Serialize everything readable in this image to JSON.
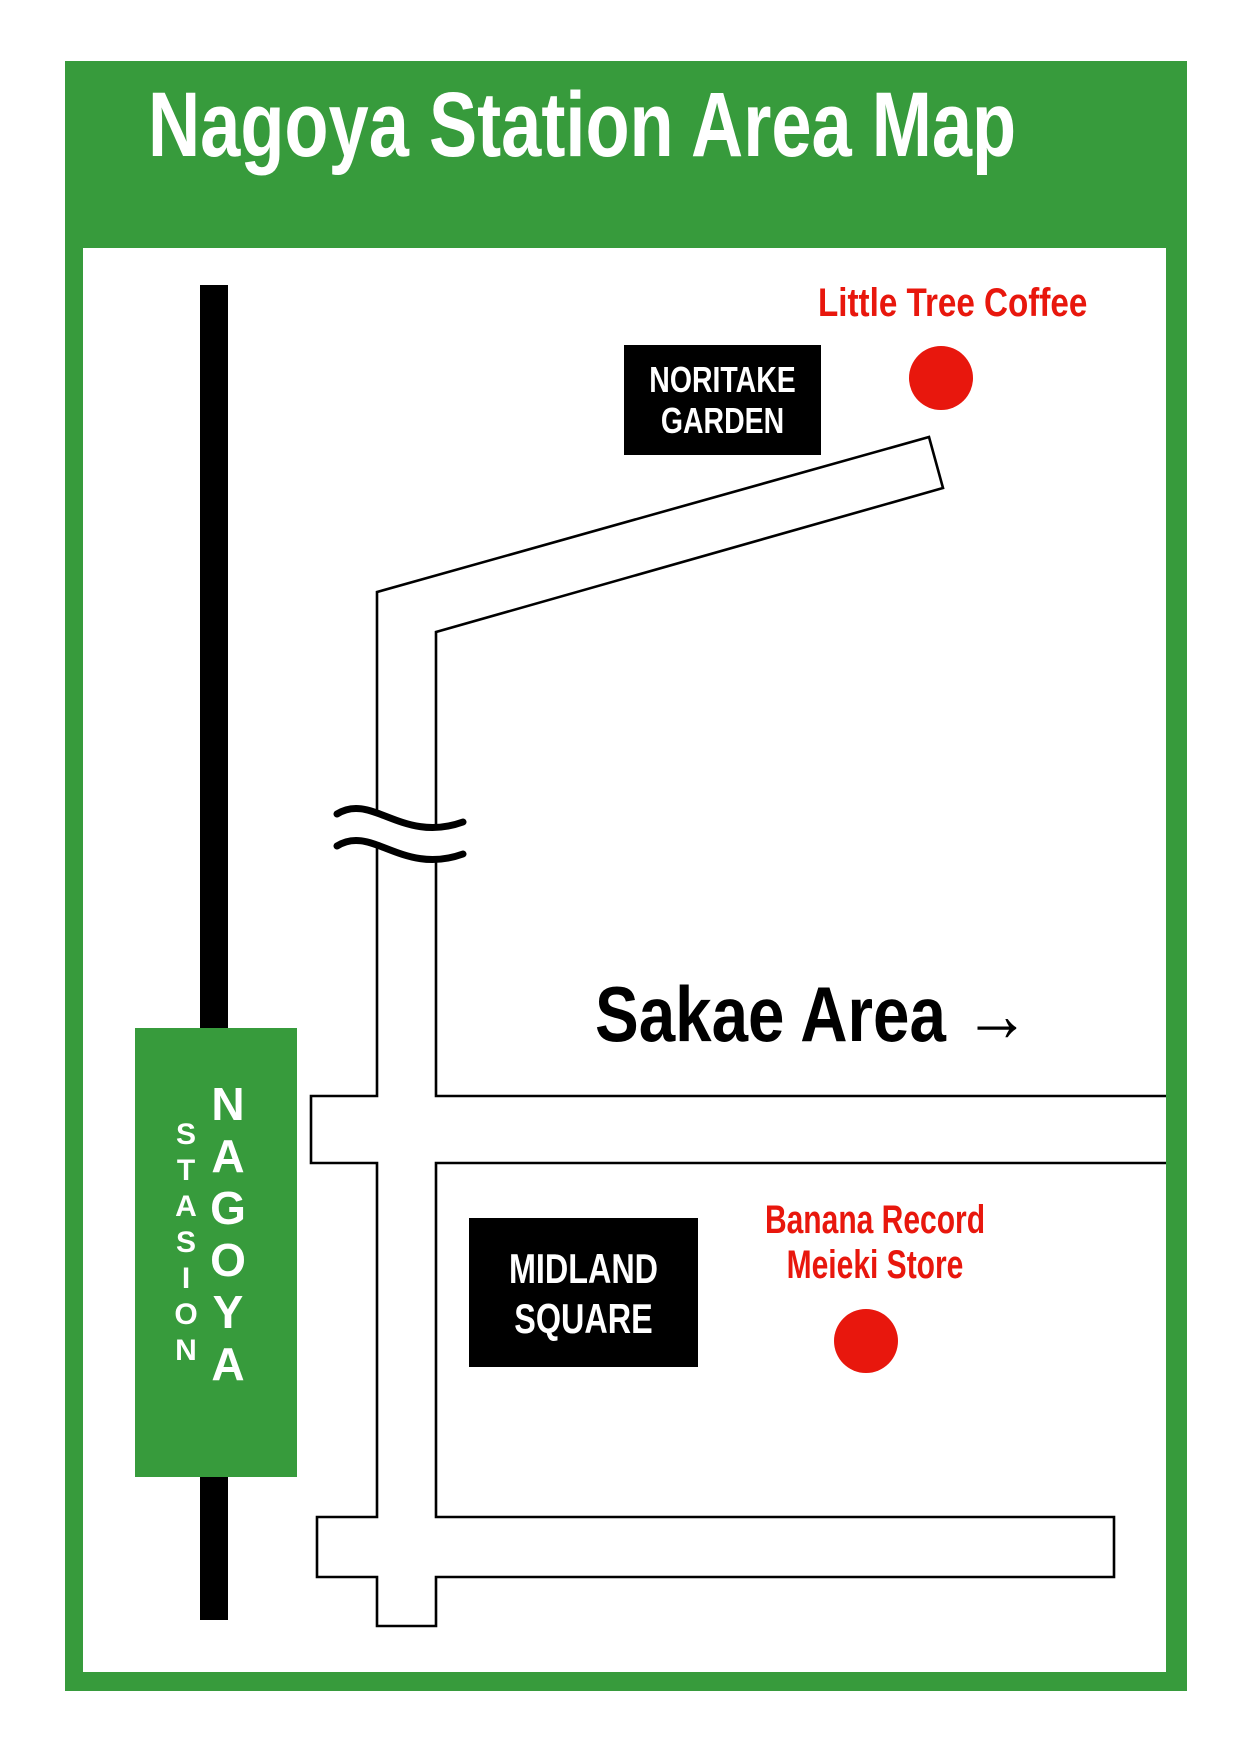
{
  "title": "Nagoya Station Area Map",
  "colors": {
    "frame_green": "#379B3C",
    "marker_red": "#E8170D",
    "road_outline": "#000000",
    "railway_black": "#000000",
    "label_white": "#FFFFFF"
  },
  "station": {
    "name": "NAGOYA",
    "name_letters": [
      "N",
      "A",
      "G",
      "O",
      "Y",
      "A"
    ],
    "subtitle": "STASION",
    "subtitle_letters": [
      "S",
      "T",
      "A",
      "S",
      "I",
      "O",
      "N"
    ]
  },
  "landmarks": {
    "noritake": {
      "line1": "NORITAKE",
      "line2": "GARDEN"
    },
    "midland": {
      "line1": "MIDLAND",
      "line2": "SQUARE"
    }
  },
  "pois": {
    "little_tree": {
      "label": "Little Tree Coffee"
    },
    "banana": {
      "line1": "Banana Record",
      "line2": "Meieki Store"
    }
  },
  "directions": {
    "sakae": {
      "label": "Sakae Area",
      "arrow": "→"
    }
  }
}
